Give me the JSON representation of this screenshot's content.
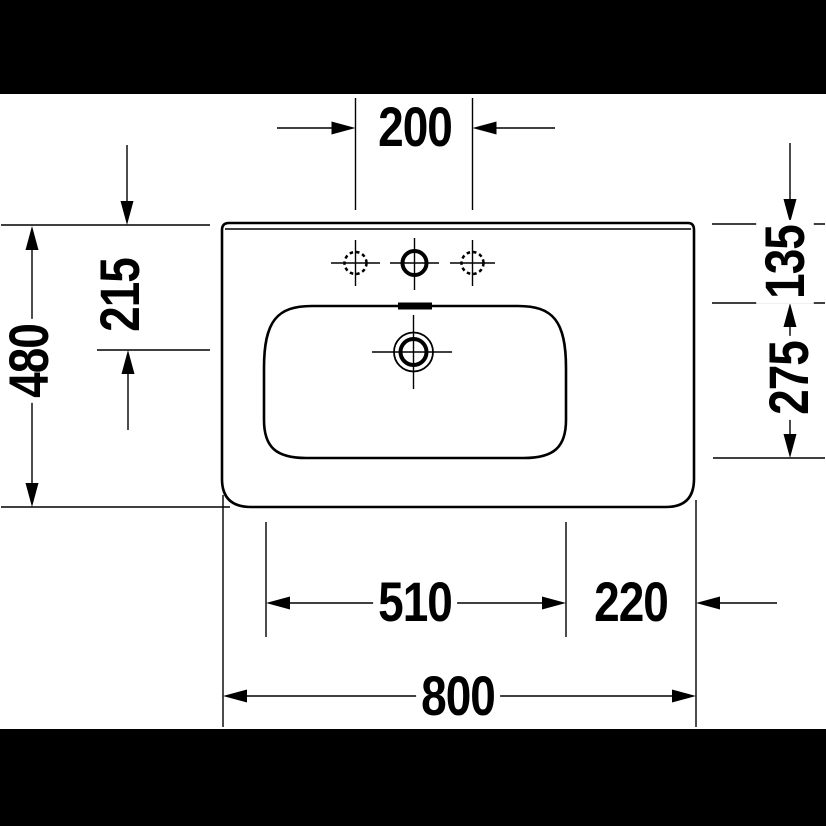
{
  "drawing": {
    "title": "washbasin-plan-technical-drawing",
    "colors": {
      "line": "#000000",
      "background": "#ffffff",
      "letterbox_bar": "#000000"
    },
    "dims": {
      "tap_hole_spacing": "200",
      "overall_depth": "480",
      "overflow_offset": "215",
      "rim_to_basin": "135",
      "basin_depth": "275",
      "basin_width": "510",
      "side_offset": "220",
      "overall_width": "800"
    }
  }
}
